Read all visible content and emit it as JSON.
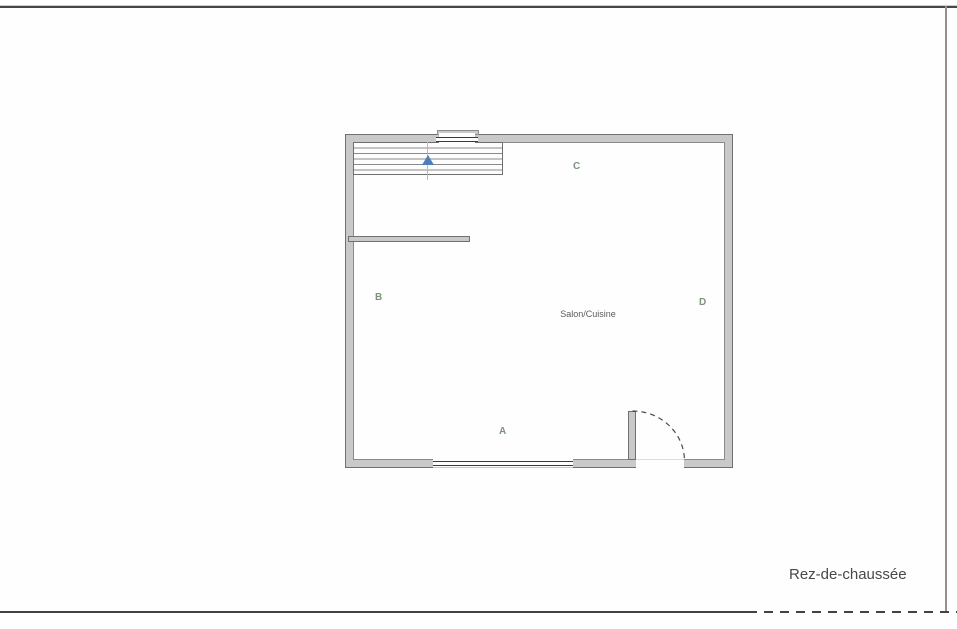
{
  "plan": {
    "floor_label": "Rez-de-chaussée",
    "room_label": "Salon/Cuisine",
    "wall_markers": [
      {
        "id": "A",
        "position": "bottom"
      },
      {
        "id": "B",
        "position": "left"
      },
      {
        "id": "C",
        "position": "top"
      },
      {
        "id": "D",
        "position": "right"
      }
    ],
    "features": [
      "stairs-top-left",
      "window-top-wall",
      "window-bottom-wall",
      "door-bottom-right",
      "interior-wall-stub-left"
    ]
  },
  "colors": {
    "wall_fill": "#c9c9c9",
    "wall_outline": "#707070",
    "window_navy": "#31317c",
    "marker_green": "#7a947a",
    "stair_arrow_blue": "#4d7fbb",
    "frame_line": "#424242",
    "background": "#fefefe"
  }
}
